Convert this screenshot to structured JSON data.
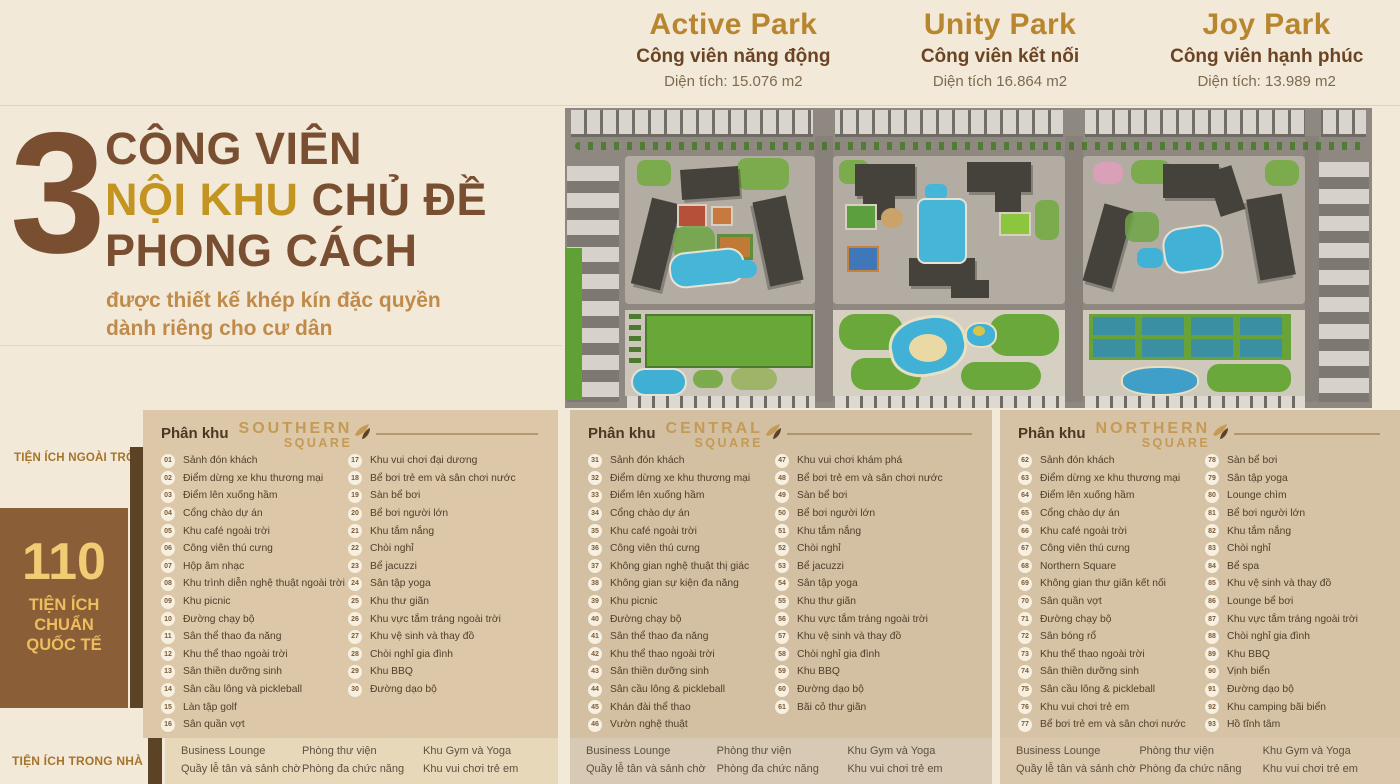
{
  "parks": [
    {
      "name": "Active Park",
      "subtitle": "Công viên năng động",
      "area": "Diện tích: 15.076 m2"
    },
    {
      "name": "Unity Park",
      "subtitle": "Công viên kết nối",
      "area": "Diện tích 16.864 m2"
    },
    {
      "name": "Joy Park",
      "subtitle": "Công viên hạnh phúc",
      "area": "Diện tích: 13.989 m2"
    }
  ],
  "hero": {
    "number": "3",
    "line1": "CÔNG VIÊN",
    "line2_accent": "NỘI KHU",
    "line2_rest": " CHỦ ĐỀ",
    "line3": "PHONG CÁCH",
    "subtitle1": "được thiết kế khép kín đặc quyền",
    "subtitle2": "dành riêng cho cư dân"
  },
  "sidebar": {
    "outdoor_label": "TIỆN ÍCH NGOÀI TRỜI",
    "count": "110",
    "count_caption": [
      "TIỆN ÍCH",
      "CHUẨN",
      "QUỐC TẾ"
    ],
    "indoor_label": "TIỆN ÍCH TRONG NHÀ"
  },
  "sections": [
    {
      "label": "Phân khu",
      "logo_line1": "SOUTHERN",
      "logo_line2": "SQUARE",
      "col1_count": 16,
      "items": [
        [
          "01",
          "Sảnh đón khách"
        ],
        [
          "02",
          "Điểm dừng xe khu thương mại"
        ],
        [
          "03",
          "Điểm lên xuống hầm"
        ],
        [
          "04",
          "Cổng chào dự án"
        ],
        [
          "05",
          "Khu café ngoài trời"
        ],
        [
          "06",
          "Công viên thú cưng"
        ],
        [
          "07",
          "Hộp âm nhạc"
        ],
        [
          "08",
          "Khu trình diễn nghệ thuật ngoài trời"
        ],
        [
          "09",
          "Khu picnic"
        ],
        [
          "10",
          "Đường chạy bộ"
        ],
        [
          "11",
          "Sân thể thao đa năng"
        ],
        [
          "12",
          "Khu thể thao ngoài trời"
        ],
        [
          "13",
          "Sân thiền dưỡng sinh"
        ],
        [
          "14",
          "Sân cầu lông và pickleball"
        ],
        [
          "15",
          "Làn tập golf"
        ],
        [
          "16",
          "Sân quần vợt"
        ],
        [
          "17",
          "Khu vui chơi đại dương"
        ],
        [
          "18",
          "Bể bơi trẻ em và sân chơi nước"
        ],
        [
          "19",
          "Sàn bể bơi"
        ],
        [
          "20",
          "Bể bơi người lớn"
        ],
        [
          "21",
          "Khu tắm nắng"
        ],
        [
          "22",
          "Chòi nghỉ"
        ],
        [
          "23",
          "Bể jacuzzi"
        ],
        [
          "24",
          "Sân tập yoga"
        ],
        [
          "25",
          "Khu thư giãn"
        ],
        [
          "26",
          "Khu vực tắm tráng ngoài trời"
        ],
        [
          "27",
          "Khu vệ sinh và thay đồ"
        ],
        [
          "28",
          "Chòi nghỉ gia đình"
        ],
        [
          "29",
          "Khu BBQ"
        ],
        [
          "30",
          "Đường dạo bộ"
        ]
      ]
    },
    {
      "label": "Phân khu",
      "logo_line1": "CENTRAL",
      "logo_line2": "SQUARE",
      "col1_count": 16,
      "items": [
        [
          "31",
          "Sảnh đón khách"
        ],
        [
          "32",
          "Điểm dừng xe khu thương mại"
        ],
        [
          "33",
          "Điểm lên xuống hầm"
        ],
        [
          "34",
          "Cổng chào dự án"
        ],
        [
          "35",
          "Khu café ngoài trời"
        ],
        [
          "36",
          "Công viên thú cưng"
        ],
        [
          "37",
          "Không gian nghệ thuật thị giác"
        ],
        [
          "38",
          "Không gian sự kiện đa năng"
        ],
        [
          "39",
          "Khu picnic"
        ],
        [
          "40",
          "Đường chạy bộ"
        ],
        [
          "41",
          "Sân thể thao đa năng"
        ],
        [
          "42",
          "Khu thể thao ngoài trời"
        ],
        [
          "43",
          "Sân thiền dưỡng sinh"
        ],
        [
          "44",
          "Sân cầu lông & pickleball"
        ],
        [
          "45",
          "Khán đài thể thao"
        ],
        [
          "46",
          "Vườn nghệ thuật"
        ],
        [
          "47",
          "Khu vui chơi khám phá"
        ],
        [
          "48",
          "Bể bơi trẻ em và sân chơi nước"
        ],
        [
          "49",
          "Sàn bể bơi"
        ],
        [
          "50",
          "Bể bơi người lớn"
        ],
        [
          "51",
          "Khu tắm nắng"
        ],
        [
          "52",
          "Chòi nghỉ"
        ],
        [
          "53",
          "Bể jacuzzi"
        ],
        [
          "54",
          "Sân tập yoga"
        ],
        [
          "55",
          "Khu thư giãn"
        ],
        [
          "56",
          "Khu vực tắm tráng ngoài trời"
        ],
        [
          "57",
          "Khu vệ sinh và thay đồ"
        ],
        [
          "58",
          "Chòi nghỉ gia đình"
        ],
        [
          "59",
          "Khu BBQ"
        ],
        [
          "60",
          "Đường dạo bộ"
        ],
        [
          "61",
          "Bãi cỏ thư giãn"
        ]
      ]
    },
    {
      "label": "Phân khu",
      "logo_line1": "NORTHERN",
      "logo_line2": "SQUARE",
      "col1_count": 16,
      "items": [
        [
          "62",
          "Sảnh đón khách"
        ],
        [
          "63",
          "Điểm dừng xe khu thương mại"
        ],
        [
          "64",
          "Điểm lên xuống hầm"
        ],
        [
          "65",
          "Cổng chào dự án"
        ],
        [
          "66",
          "Khu café ngoài trời"
        ],
        [
          "67",
          "Công viên thú cưng"
        ],
        [
          "68",
          "Northern Square"
        ],
        [
          "69",
          "Không gian thư giãn kết nối"
        ],
        [
          "70",
          "Sân quần vợt"
        ],
        [
          "71",
          "Đường chạy bộ"
        ],
        [
          "72",
          "Sân bóng rổ"
        ],
        [
          "73",
          "Khu thể thao ngoài trời"
        ],
        [
          "74",
          "Sân thiền dưỡng sinh"
        ],
        [
          "75",
          "Sân cầu lông & pickleball"
        ],
        [
          "76",
          "Khu vui chơi trẻ em"
        ],
        [
          "77",
          "Bể bơi trẻ em và sân chơi nước"
        ],
        [
          "78",
          "Sàn bể bơi"
        ],
        [
          "79",
          "Sân tập yoga"
        ],
        [
          "80",
          "Lounge chìm"
        ],
        [
          "81",
          "Bể bơi người lớn"
        ],
        [
          "82",
          "Khu tắm nắng"
        ],
        [
          "83",
          "Chòi nghỉ"
        ],
        [
          "84",
          "Bể spa"
        ],
        [
          "85",
          "Khu vệ sinh và thay đồ"
        ],
        [
          "86",
          "Lounge bể bơi"
        ],
        [
          "87",
          "Khu vực tắm tráng ngoài trời"
        ],
        [
          "88",
          "Chòi nghỉ gia đình"
        ],
        [
          "89",
          "Khu BBQ"
        ],
        [
          "90",
          "Vịnh biển"
        ],
        [
          "91",
          "Đường dạo bộ"
        ],
        [
          "92",
          "Khu camping bãi biển"
        ],
        [
          "93",
          "Hồ tĩnh tâm"
        ]
      ]
    }
  ],
  "indoor_columns": [
    [
      "Business Lounge",
      "Quầy lễ tân và sảnh chờ"
    ],
    [
      "Phòng thư viện",
      "Phòng đa chức năng"
    ],
    [
      "Khu Gym và Yoga",
      "Khu vui chơi trẻ em"
    ]
  ],
  "colors": {
    "page_cream": "#f2e9d9",
    "title_brown": "#7a4f31",
    "accent_gold": "#c3941f",
    "park_name_gold": "#b8862f",
    "panel_tan_southern": "#dcc7a8",
    "panel_tan_central": "#d3bfa2",
    "panel_tan_northern": "#d6c2a4",
    "count_box_brown": "#8a5f38",
    "count_gold": "#f2cc74",
    "accent_bar_brown": "#5c4326",
    "label_gold": "#a5742b",
    "pool_blue": "#45b6d8",
    "lawn_green": "#67a839"
  }
}
